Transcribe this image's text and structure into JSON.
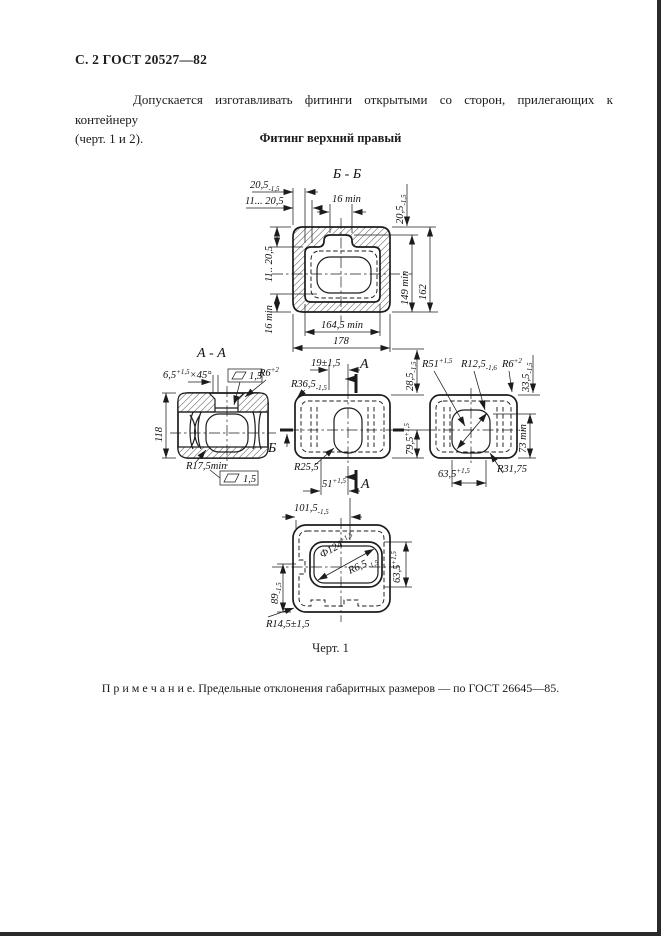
{
  "meta": {
    "header": "С. 2 ГОСТ 20527—82",
    "intro_line1": "Допускается изготавливать фитинги открытыми со сторон, прилегающих к контейнеру",
    "intro_line2": "(черт. 1 и 2).",
    "figure_title": "Фитинг верхний правый",
    "figure_caption": "Черт. 1",
    "note": "П р и м е ч а н и е. Предельные отклонения габаритных размеров — по ГОСТ 26645—85.",
    "ink_color": "#1c1c1c"
  },
  "top_view": {
    "title": "Б - Б",
    "dims": {
      "t1": {
        "v": "20,5",
        "t": "-1,5"
      },
      "t2": {
        "v": "11... 20,5"
      },
      "t3": {
        "v": "16 min"
      },
      "t4": {
        "v": "20,5",
        "t": "-1,5"
      },
      "t5": {
        "v": "11.. 20,5"
      },
      "t6": {
        "v": "16 min"
      },
      "t7": {
        "v": "164,5 min"
      },
      "t8": {
        "v": "178"
      },
      "t9": {
        "v": "149 min"
      },
      "t10": {
        "v": "162"
      }
    }
  },
  "aa_view": {
    "title": "А - А",
    "dims": {
      "chamfer": {
        "v": "6,5",
        "t": "+1,5",
        "s": "×45°"
      },
      "finish_top": "1,5",
      "height": {
        "v": "118"
      },
      "r175": {
        "v": "R17,5min"
      },
      "finish_bottom": "1,5",
      "cut_label": "Б"
    }
  },
  "front_view": {
    "dims": {
      "d19": {
        "v": "19±1,5"
      },
      "r365": {
        "v": "R36,5",
        "t": "-1,5"
      },
      "r6": {
        "v": "R6",
        "t": "+2"
      },
      "cut_top": "А",
      "d285": {
        "v": "28,5",
        "t": "-1,5"
      },
      "d795": {
        "v": "79,5",
        "t": "+1,5"
      },
      "r255": {
        "v": "R25,5"
      },
      "d51": {
        "v": "51",
        "t": "+1,5"
      },
      "cut_bottom": "А"
    }
  },
  "side_view": {
    "dims": {
      "r51": {
        "v": "R51",
        "t": "+1,5"
      },
      "r125": {
        "v": "R12,5",
        "t": "-1,6"
      },
      "r6": {
        "v": "R6",
        "t": "+2"
      },
      "d335": {
        "v": "33,5",
        "t": "-1,5"
      },
      "d73": {
        "v": "73 min"
      },
      "d635": {
        "v": "63,5",
        "t": "+1,5"
      },
      "r3175": {
        "v": "R31,75"
      }
    }
  },
  "bottom_view": {
    "dims": {
      "d1015": {
        "v": "101,5",
        "t": "-1,5"
      },
      "dia124": {
        "v": "Ф124",
        "t": "+1,5"
      },
      "r65": {
        "v": "R6,5",
        "t": "-1,5"
      },
      "d635": {
        "v": "63,5",
        "t": "+1,5"
      },
      "d89": {
        "v": "89",
        "t": "-1,5"
      },
      "r145": {
        "v": "R14,5±1,5"
      }
    }
  }
}
